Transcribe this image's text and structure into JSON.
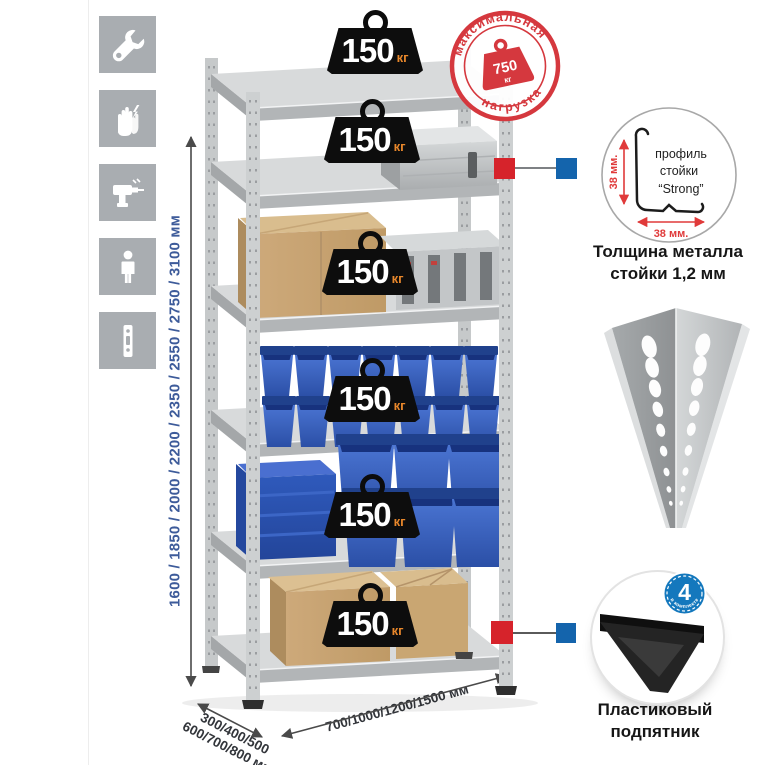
{
  "sidebar_icons": [
    "wrench-icon",
    "gloves-icon",
    "drill-icon",
    "person-icon",
    "rack-post-icon"
  ],
  "dimensions": {
    "height_label": "1600 / 1850 / 2000 / 2200 / 2350 / 2550 / 2750 / 3100 мм",
    "depth_line1": "300/400/500",
    "depth_line2": "600/700/800 мм",
    "width_label": "700/1000/1200/1500 мм"
  },
  "max_load_stamp": {
    "arc_top": "максимальная",
    "arc_bottom": "нагрузка",
    "value": "750",
    "unit": "кг"
  },
  "shelves": {
    "badges": [
      {
        "value": "150",
        "unit": "кг"
      },
      {
        "value": "150",
        "unit": "кг"
      },
      {
        "value": "150",
        "unit": "кг"
      },
      {
        "value": "150",
        "unit": "кг"
      },
      {
        "value": "150",
        "unit": "кг"
      },
      {
        "value": "150",
        "unit": "кг"
      }
    ]
  },
  "profile_detail": {
    "label_line1": "профиль",
    "label_line2": "стойки",
    "label_line3": "“Strong”",
    "dim_vertical": "38 мм.",
    "dim_horizontal": "38 мм.",
    "caption_line1": "Толщина металла",
    "caption_line2": "стойки 1,2 мм"
  },
  "foot_detail": {
    "badge_value": "4",
    "badge_arc_text": "в комплекте",
    "caption_line1": "Пластиковый",
    "caption_line2": "подпятник"
  },
  "colors": {
    "stamp_red": "#d5383e",
    "marker_red": "#d6232b",
    "marker_blue": "#1464ac",
    "dimension_text_blue": "#3d5b9a",
    "badge_unit_orange": "#e8872b",
    "bin_blue": "#2f5dc0",
    "kit_badge_blue": "#1478bd"
  }
}
